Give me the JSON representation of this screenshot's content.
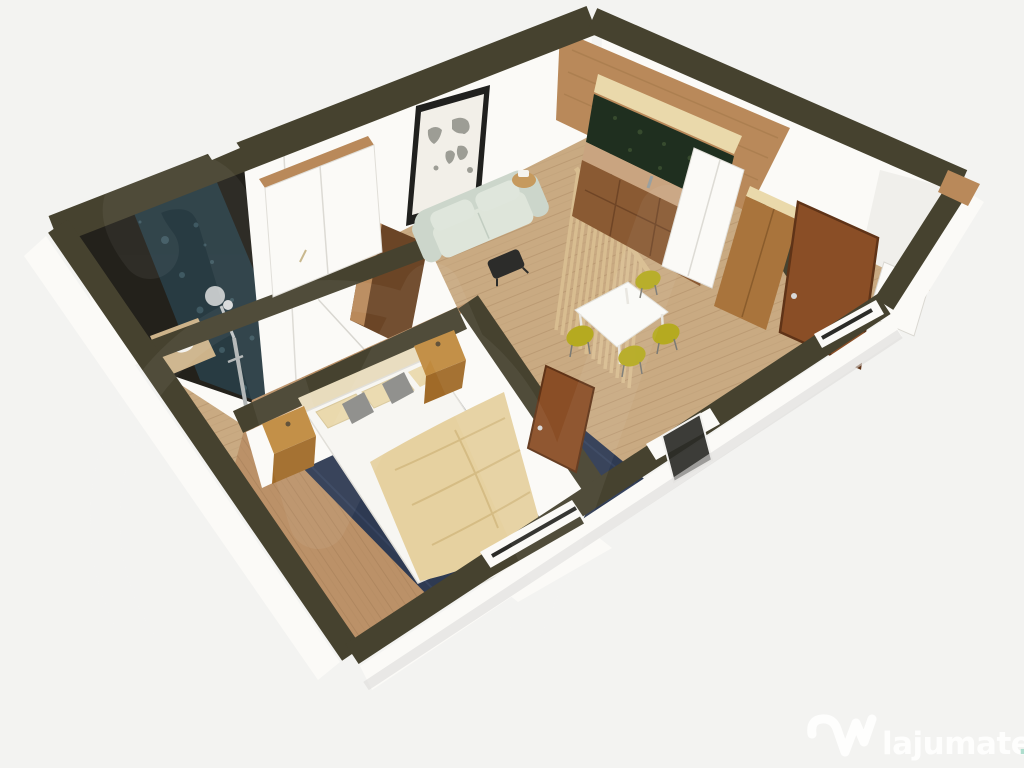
{
  "watermark": {
    "brand": "lajumate",
    "tld": ".ro",
    "logo_icon": "lajumate-w-logo",
    "corner": "bottom-right"
  },
  "scene": {
    "type": "3d-floorplan-render",
    "rooms": [
      "bathroom",
      "bedroom",
      "living-dining",
      "kitchen",
      "entry-hall"
    ]
  },
  "colors": {
    "bg": "#f3f3f1",
    "wallTop": "#46422f",
    "wallTopDark": "#353124",
    "faceWhite": "#fbfaf7",
    "faceShade": "#e9e7e2",
    "floorLiving": "#c9aa82",
    "floorBedroom": "#bb9168",
    "plank": "#8f6a45",
    "rug": "#2e3a52",
    "rugEdge": "#3d4b6a",
    "blanket": "#e6d1a0",
    "blanketFold": "#d2b77e",
    "pillowBeige": "#ead9ad",
    "pillowGray": "#8b8b88",
    "bedWhite": "#f7f6f2",
    "headboard": "#e8dcbd",
    "wood": "#b9895a",
    "woodDark": "#6b4526",
    "nightstand": "#c08a3e",
    "nightstandDark": "#a06a28",
    "tealWall": "#283b42",
    "tealSpeck": "#4a6670",
    "bathDark": "#23211b",
    "backsplash": "#1f2f1f",
    "cabinet": "#8a5a33",
    "counter": "#c9a480",
    "woodPanelLight": "#ead9ab",
    "door": "#8a4e26",
    "doorEdge": "#5f3317",
    "chair": "#b5aa20",
    "sofa": "#ccd6cb",
    "sofaSeat": "#dee5da",
    "slat": "#d8bd90",
    "frame": "#20201e",
    "mapCanvas": "#f2efe8",
    "mapInk": "#8f8f87",
    "metal": "#c2c6c7",
    "glass": "#2b2b27",
    "logoWhite": "#ffffff",
    "logoTld": "#a9dccb"
  }
}
